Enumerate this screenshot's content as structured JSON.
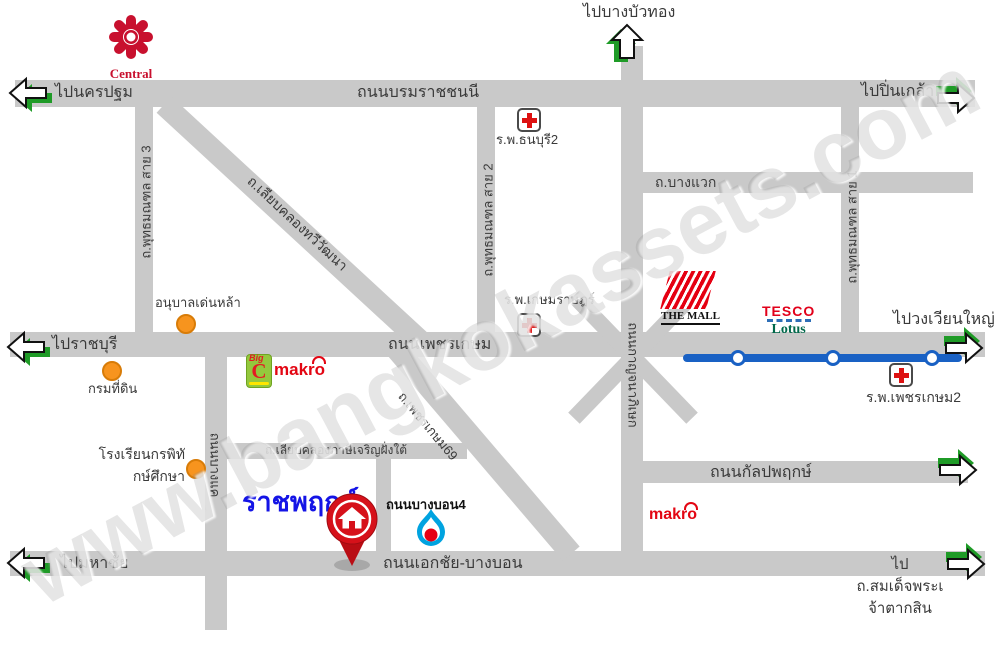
{
  "watermark": "www.bangkokassets.com",
  "roads": {
    "borommaratchachonnani": "ถนนบรมราชชนนี",
    "phetkasem": "ถนนเพชรเกษม",
    "ekkachai_bangbon": "ถนนเอกชัย-บางบอน",
    "kalapapruek": "ถนนกัลปพฤกษ์",
    "bangwaek": "ถ.บางแวก",
    "phutthamonthon_sai3": "ถ.พุทธมณฑล สาย 3",
    "phutthamonthon_sai2": "ถ.พุทธมณฑล สาย 2",
    "phutthamonthon_sai1": "ถ.พุทธมณฑล สาย 1",
    "kanchanaphisek": "ถนนกาญจนาภิเษก",
    "bangkhae": "ถนนบางแค",
    "liab_khlong_thawiwatthana": "ถ.เลียบคลองทวีวัฒนา",
    "phetkasem69": "ถ.เพชรเกษม69",
    "liab_khlong_phasi_charoen_south": "ถ.เลียบคลองภาษีเจริญฝั่งใต้",
    "bangbon4": "ถนนบางบอน4"
  },
  "directions": {
    "nakhon_pathom": "ไปนครปฐม",
    "bang_bua_thong": "ไปบางบัวทอง",
    "pin_klao": "ไปปิ่นเกล้า",
    "ratchaburi": "ไปราชบุรี",
    "wongwian_yai": "ไปวงเวียนใหญ่",
    "maha_chai": "ไปมหาชัย",
    "taksin_line1": "ไป",
    "taksin_line2": "ถ.สมเด็จพระเ",
    "taksin_line3": "จ้าตากสิน"
  },
  "places": {
    "central": "Central",
    "thonburi2_hospital": "ร.พ.ธนบุรี2",
    "kasemrat_hospital": "ร.พ.เกษมราษฎร์",
    "phetkasem2_hospital": "ร.พ.เพชรเกษม2",
    "anuban_denla": "อนุบาลเด่นหล้า",
    "land_department": "กรมที่ดิน",
    "kornpitack_school_line1": "โรงเรียนกรพิทั",
    "kornpitack_school_line2": "กษ์ศึกษา",
    "the_mall": "THE MALL",
    "tesco": "TESCO",
    "lotus": "Lotus",
    "big_c_word": "Big",
    "big_c_letter": "C",
    "makro_phetkasem": "makro",
    "makro_kalapapruek": "makro",
    "ratchaphruek_project": "ราชพฤกษ์"
  },
  "colors": {
    "road_gray": "#c9c9c9",
    "arrow_green": "#1f9b27",
    "mrt_blue": "#1961c4",
    "pin_red": "#d6111a",
    "poi_orange": "#F7941E",
    "project_blue": "#1414e6",
    "hospital_cross_red": "#dd1111",
    "brand_red": "#e30613",
    "bigc_green": "#94C83D",
    "tesco_green": "#00684A"
  }
}
